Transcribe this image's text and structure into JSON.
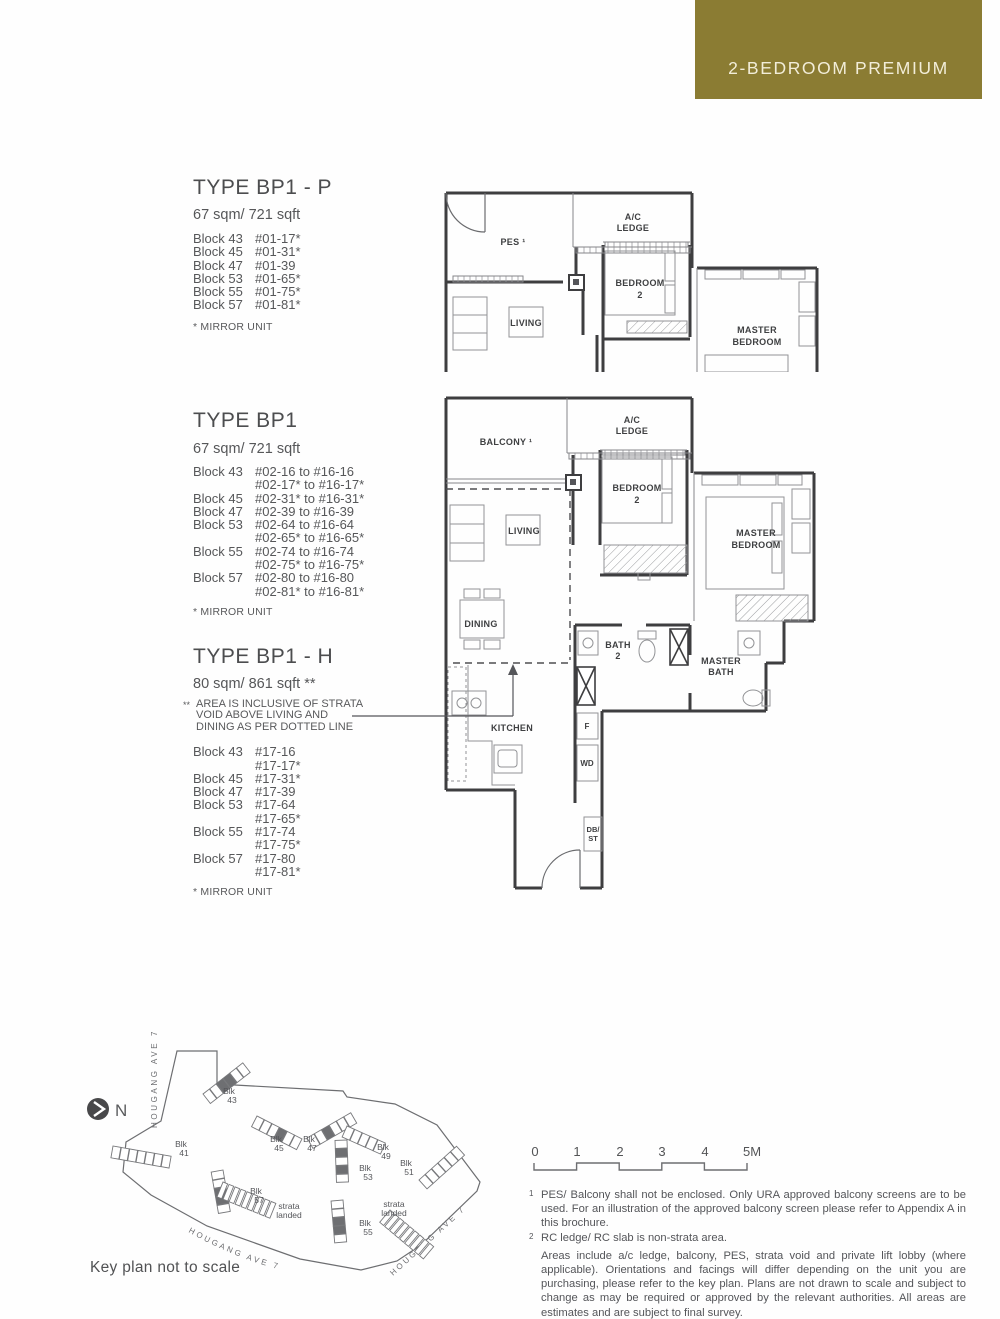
{
  "badge": {
    "label": "2-BEDROOM PREMIUM",
    "bg": "#8b7c33",
    "fg": "#f2edd8"
  },
  "types": [
    {
      "title": "TYPE BP1 - P",
      "area": "67 sqm/ 721 sqft",
      "rows": [
        {
          "block": "Block 43",
          "unit": "#01-17*"
        },
        {
          "block": "Block 45",
          "unit": "#01-31*"
        },
        {
          "block": "Block 47",
          "unit": "#01-39"
        },
        {
          "block": "Block 53",
          "unit": "#01-65*"
        },
        {
          "block": "Block 55",
          "unit": "#01-75*"
        },
        {
          "block": "Block 57",
          "unit": "#01-81*"
        }
      ],
      "mirror_note": "* MIRROR UNIT"
    },
    {
      "title": "TYPE BP1",
      "area": "67 sqm/ 721 sqft",
      "rows": [
        {
          "block": "Block 43",
          "unit": "#02-16 to #16-16"
        },
        {
          "block": "",
          "unit": "#02-17* to #16-17*"
        },
        {
          "block": "Block 45",
          "unit": "#02-31* to #16-31*"
        },
        {
          "block": "Block 47",
          "unit": "#02-39 to #16-39"
        },
        {
          "block": "Block 53",
          "unit": "#02-64 to #16-64"
        },
        {
          "block": "",
          "unit": "#02-65* to #16-65*"
        },
        {
          "block": "Block 55",
          "unit": "#02-74 to #16-74"
        },
        {
          "block": "",
          "unit": "#02-75* to #16-75*"
        },
        {
          "block": "Block 57",
          "unit": "#02-80 to #16-80"
        },
        {
          "block": "",
          "unit": "#02-81* to #16-81*"
        }
      ],
      "mirror_note": "* MIRROR UNIT"
    },
    {
      "title": "TYPE BP1 - H",
      "area": "80 sqm/ 861 sqft **",
      "area_note_marker": "**",
      "area_note": "AREA IS INCLUSIVE OF STRATA VOID ABOVE LIVING AND DINING AS PER DOTTED LINE",
      "rows": [
        {
          "block": "Block 43",
          "unit": "#17-16"
        },
        {
          "block": "",
          "unit": "#17-17*"
        },
        {
          "block": "Block 45",
          "unit": "#17-31*"
        },
        {
          "block": "Block 47",
          "unit": "#17-39"
        },
        {
          "block": "Block 53",
          "unit": "#17-64"
        },
        {
          "block": "",
          "unit": "#17-65*"
        },
        {
          "block": "Block 55",
          "unit": "#17-74"
        },
        {
          "block": "",
          "unit": "#17-75*"
        },
        {
          "block": "Block 57",
          "unit": "#17-80"
        },
        {
          "block": "",
          "unit": "#17-81*"
        }
      ],
      "mirror_note": "* MIRROR UNIT"
    }
  ],
  "plan_labels": {
    "pes": "PES ¹",
    "balcony": "BALCONY ¹",
    "ac1": "A/C",
    "ac2": "LEDGE",
    "bed2a": "BEDROOM",
    "bed2b": "2",
    "living": "LIVING",
    "master1": "MASTER",
    "master2": "BEDROOM",
    "dining": "DINING",
    "kitchen": "KITCHEN",
    "bath2a": "BATH",
    "bath2b": "2",
    "mbath1": "MASTER",
    "mbath2": "BATH",
    "fridge": "F",
    "wd": "WD",
    "db1": "DB/",
    "db2": "ST"
  },
  "key_plan": {
    "north": "N",
    "blk_word": "Blk",
    "blocks": [
      "43",
      "45",
      "47",
      "49",
      "41",
      "51",
      "53",
      "57",
      "55"
    ],
    "strata_w1": "strata",
    "strata_w2": "landed",
    "roads": [
      "HOUGANG AVE 7",
      "HOUGANG AVE 7",
      "HOUGANG AVE 7"
    ],
    "note": "Key plan not to scale"
  },
  "scale_bar": {
    "labels": [
      "0",
      "1",
      "2",
      "3",
      "4",
      "5M"
    ]
  },
  "footnotes": [
    {
      "sup": "1",
      "text": "PES/ Balcony shall not be enclosed. Only URA approved balcony screens are to be used. For an illustration of the approved balcony screen please refer to Appendix A in this brochure."
    },
    {
      "sup": "2",
      "text": "RC ledge/ RC slab is non-strata area."
    },
    {
      "sup": "",
      "text": "Areas include a/c ledge, balcony, PES, strata void and private lift lobby (where applicable). Orientations and facings will differ depending on the unit you are purchasing, please refer to the key plan. Plans are not drawn to scale and subject to change as may be required or approved by the relevant authorities. All areas are estimates and are subject to final survey."
    }
  ]
}
